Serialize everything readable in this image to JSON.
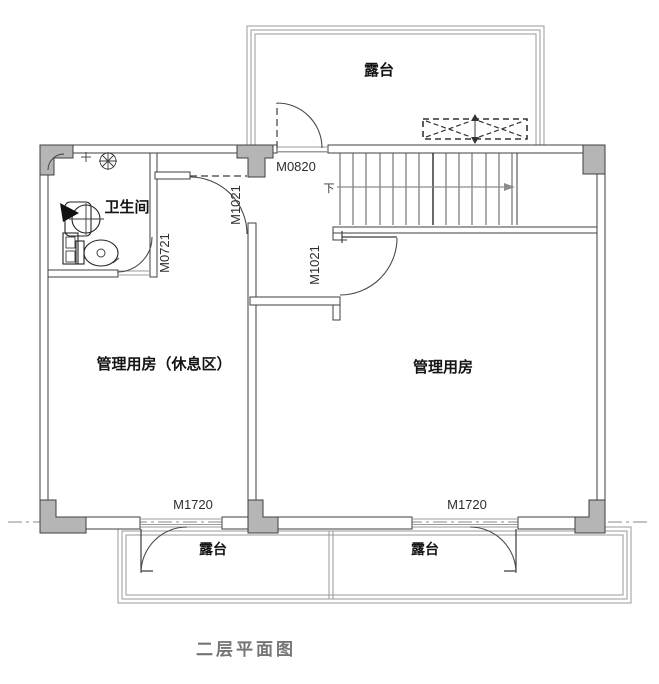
{
  "drawing": {
    "title": "二层平面图",
    "rooms": {
      "bathroom": "卫生间",
      "left_room": "管理用房（休息区）",
      "right_room": "管理用房",
      "terrace_top": "露台",
      "terrace_bottom_left": "露台",
      "terrace_bottom_right": "露台"
    },
    "doors": {
      "m0820": "M0820",
      "m1021_upper": "M1021",
      "m1021_lower": "M1021",
      "m0721": "M0721",
      "m1720_left": "M1720",
      "m1720_right": "M1720"
    },
    "stairs": {
      "direction_label": "下"
    },
    "colors": {
      "line": "#3f3f3f",
      "wall_fill": "#ffffff",
      "column_fill": "#b5b5b5",
      "terrace_line": "#9a9a9a",
      "stair_line": "#5a5a5a",
      "arrow": "#8d8d8d",
      "label": "#141414",
      "door_label": "#2e2e2e",
      "title": "#757575",
      "background": "#ffffff"
    }
  }
}
